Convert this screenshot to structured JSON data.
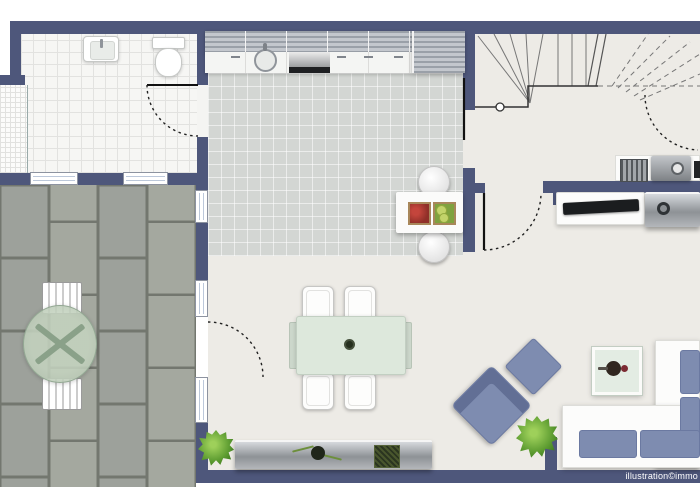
{
  "watermark": "illustration©immo",
  "colors": {
    "wall": "#4e577b",
    "floor": "#edebe6",
    "bath": "#f6f6f4",
    "tile": "#d3d6d3",
    "paver": "#9da19b",
    "paver_gap": "#73776f",
    "accent_blue": "#7e8cb0",
    "mint": "#dde8dc",
    "plant_green": "#5d9c31"
  },
  "furniture": {
    "bathroom": [
      "sink",
      "toilet",
      "shower-grid"
    ],
    "kitchen": [
      "upper-cabinets",
      "counter",
      "round-sink",
      "stove",
      "tall-cabinet",
      "island-with-crates",
      "two-stools"
    ],
    "stair_hall": [
      "winder-staircase"
    ],
    "dining": [
      "table-with-four-chairs",
      "sideboard",
      "vase",
      "moss-box",
      "plant"
    ],
    "living": [
      "l-shaped-sofa",
      "armchair",
      "ottoman",
      "coffee-table",
      "plant",
      "desk-with-tv",
      "side-unit"
    ],
    "upper_room": [
      "shelf",
      "printer"
    ],
    "terrace": [
      "round-glass-table",
      "two-slat-chairs"
    ]
  }
}
